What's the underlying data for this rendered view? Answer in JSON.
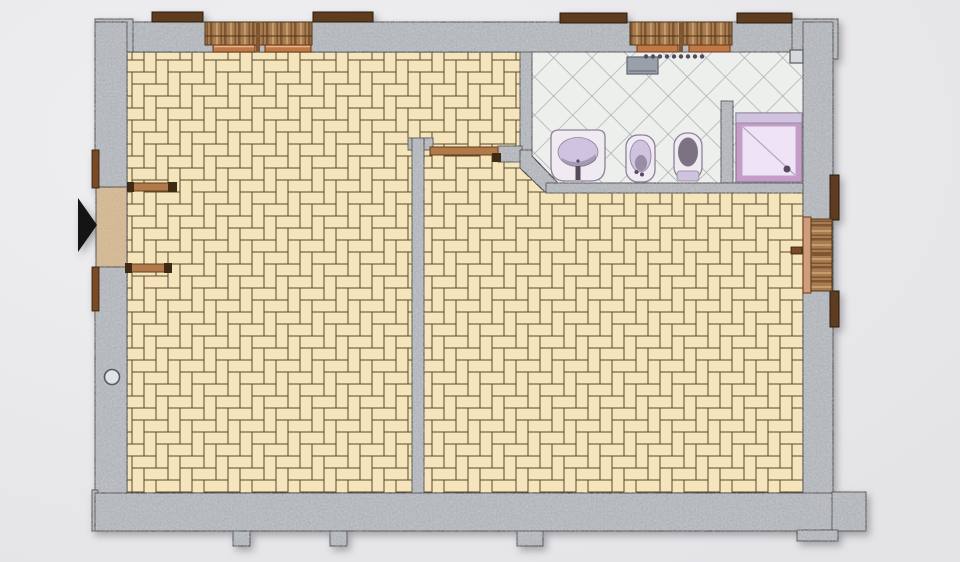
{
  "app": {
    "type": "architectural-floor-plan",
    "view": "2d-top-down-apartment"
  },
  "colors": {
    "background": "#ebebed",
    "wall_fill": "#b6bac0",
    "wall_outline": "#26262a",
    "floor_tile": "#f6e5bb",
    "floor_grout": "#554a30",
    "bath_tile": "#edefec",
    "bath_tile_line": "#a9aeb2",
    "wood_base": "#a87c50",
    "wood_dark": "#7e5732",
    "wood_light": "#c59c6c",
    "wood_frame": "#4a3318",
    "lintel": "#5d3c1f",
    "lintel_edge": "#2a1a0c",
    "sill": "#c07946",
    "sill_edge": "#6b3a1a",
    "sill_highlight": "#e8b68a",
    "right_sill": "#cf9d79",
    "threshold": "#d9b98f",
    "door_jamb": "#7a4a24",
    "door_leaf": "#b07a4a",
    "door_leaf_dark": "#3f2a16",
    "fixture_body": "#f0eaf3",
    "fixture_shade": "#cfc3e0",
    "fixture_dark": "#564a5e",
    "fixture_outline": "#8d8295",
    "shower_rim": "#c79bc7",
    "shower_inner": "#eee4f6",
    "shower_line": "#b9a4c4",
    "metal_gray": "#99a0a9",
    "metal_gray_edge": "#5f666e",
    "entrance_arrow": "#141414",
    "pilaster": "#d6d9dc",
    "pipe_fill": "#e0e3e6",
    "pipe_edge": "#55595e"
  },
  "legend": {
    "entrance_marker": "black triangle arrow at left exterior door",
    "floor_main": "beige basketweave parquet",
    "floor_bathroom": "diagonal ceramic tile"
  },
  "fixtures": [
    {
      "name": "washbasin"
    },
    {
      "name": "bidet"
    },
    {
      "name": "toilet"
    },
    {
      "name": "shower-tray"
    },
    {
      "name": "towel-radiator"
    },
    {
      "name": "wall-cabinet"
    }
  ],
  "openings": [
    {
      "name": "entrance-double-door",
      "side": "left"
    },
    {
      "name": "window-living",
      "side": "top"
    },
    {
      "name": "window-bathroom",
      "side": "top"
    },
    {
      "name": "window-right",
      "side": "right"
    },
    {
      "name": "interior-door",
      "side": "partition"
    }
  ]
}
